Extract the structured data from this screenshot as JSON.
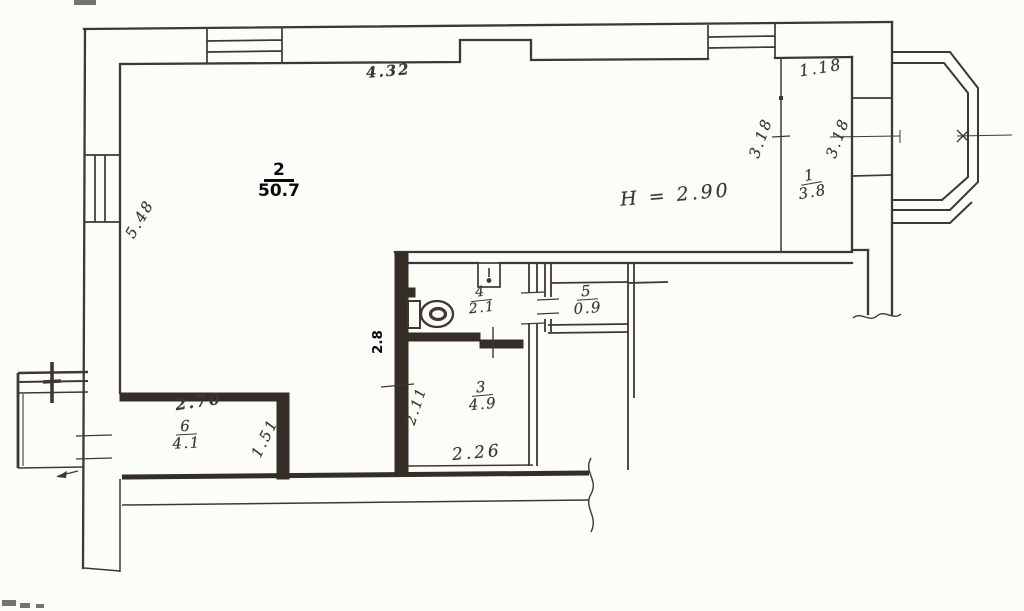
{
  "drawing": {
    "title": "apartment floor plan",
    "colors": {
      "paper": "#fcfcf9",
      "ink": "#3e3830",
      "print": "#0a0a0a"
    },
    "rooms": {
      "r1": {
        "number": "1",
        "area": "3.8"
      },
      "r2": {
        "number": "2",
        "area": "50.7"
      },
      "r3": {
        "number": "3",
        "area": "4.9"
      },
      "r4": {
        "number": "4",
        "area": "2.1"
      },
      "r5": {
        "number": "5",
        "area": "0.9"
      },
      "r6": {
        "number": "6",
        "area": "4.1"
      }
    },
    "notes": {
      "ceiling_height": "H = 2.90"
    },
    "dimensions": {
      "top_wall": "4.32",
      "room1_width": "1.18",
      "room1_height_left": "3.18",
      "room1_height_right": "3.18",
      "left_wall": "5.48",
      "room6_width": "2.70",
      "room6_depth": "1.51",
      "corridor": "2.26",
      "room3_depth": "2.11",
      "room3_width": "2.8"
    },
    "fixtures": {
      "toilet": "toilet-icon",
      "sink": "sink-icon"
    }
  }
}
